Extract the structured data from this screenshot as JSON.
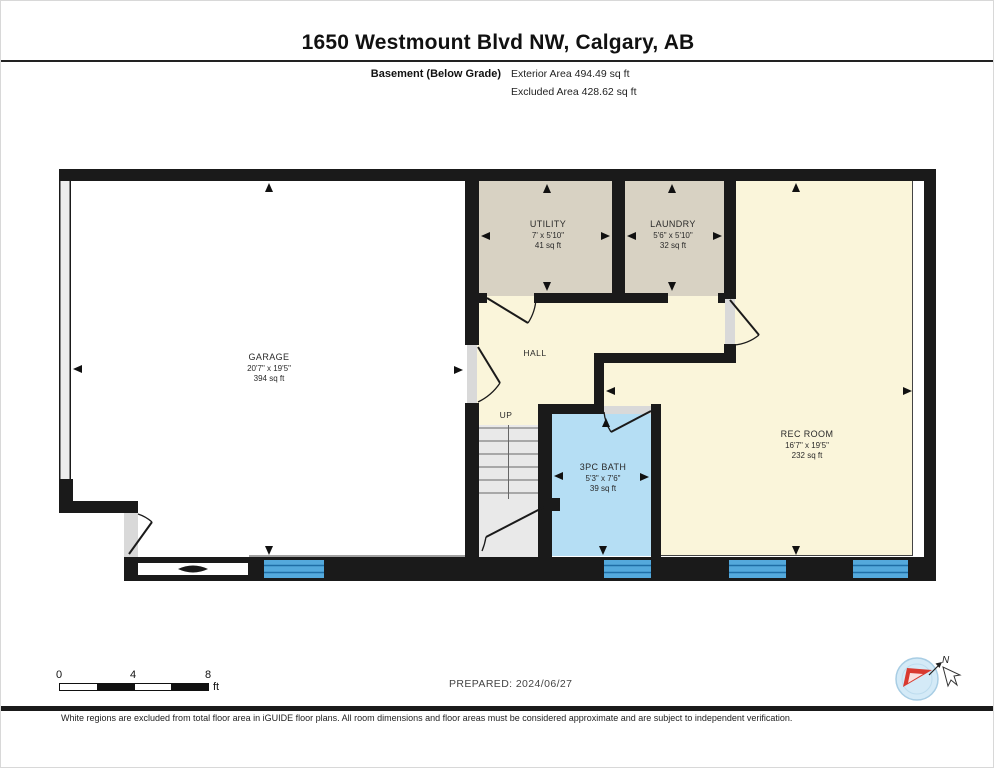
{
  "header": {
    "title": "1650 Westmount Blvd NW, Calgary, AB",
    "level_label": "Basement (Below Grade)",
    "exterior_area": "Exterior Area 494.49 sq ft",
    "excluded_area": "Excluded Area 428.62 sq ft"
  },
  "rooms": {
    "garage": {
      "name": "GARAGE",
      "dims": "20'7\" x 19'5\"",
      "area": "394 sq ft"
    },
    "utility": {
      "name": "UTILITY",
      "dims": "7' x 5'10\"",
      "area": "41 sq ft"
    },
    "laundry": {
      "name": "LAUNDRY",
      "dims": "5'6\" x 5'10\"",
      "area": "32 sq ft"
    },
    "hall": {
      "name": "HALL"
    },
    "stairs": {
      "label": "UP"
    },
    "bath": {
      "name": "3PC BATH",
      "dims": "5'3\" x 7'6\"",
      "area": "39 sq ft"
    },
    "rec_room": {
      "name": "REC ROOM",
      "dims": "16'7\" x 19'5\"",
      "area": "232 sq ft"
    }
  },
  "scale_bar": {
    "tick_0": "0",
    "tick_4": "4",
    "tick_8": "8",
    "unit": "ft"
  },
  "prepared": {
    "text": "PREPARED: 2024/06/27"
  },
  "compass": {
    "north_label": "N"
  },
  "footer": {
    "disclaimer": "White regions are excluded from total floor area in iGUIDE floor plans. All room dimensions and floor areas must be considered approximate and are subject to independent verification."
  },
  "colors": {
    "wall": "#1a1a1a",
    "window": "#54a9dc",
    "room_beige": "#d8d2c3",
    "room_yellow": "#faf5da",
    "bath_blue": "#b5def4",
    "stairs_gray": "#e9e9e9",
    "door_gray": "#d9d9d9",
    "compass_blue": "#d4eaf7",
    "compass_red": "#d93a30"
  }
}
